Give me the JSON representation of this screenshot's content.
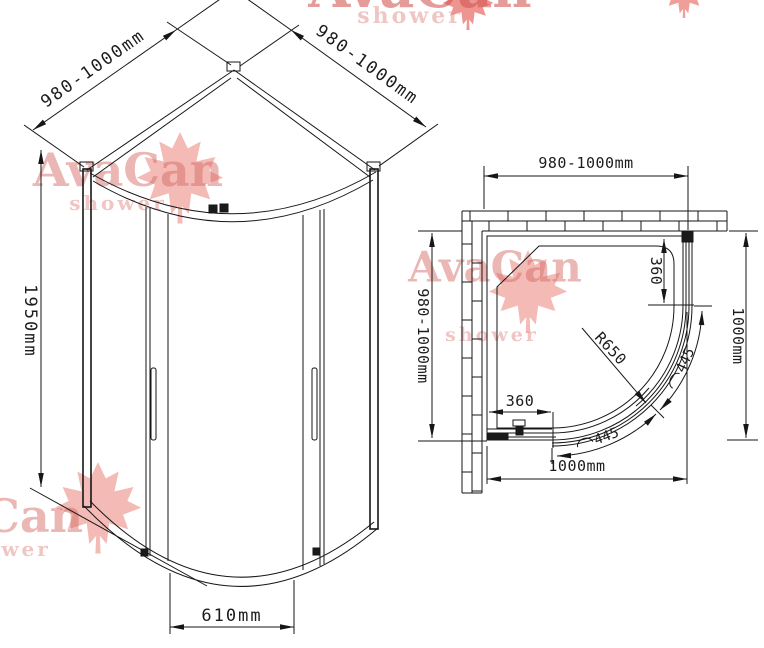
{
  "brand": {
    "name": "AvaCan",
    "tagline": "shower"
  },
  "front_view": {
    "left_width_dim": "980-1000mm",
    "right_width_dim": "980-1000mm",
    "height_dim": "1950mm",
    "door_opening_dim": "610mm"
  },
  "plan_view": {
    "top_width_dim": "980-1000mm",
    "left_depth_dim": "980-1000mm",
    "right_depth_dim": "1000mm",
    "bottom_width_dim": "1000mm",
    "right_fixed_panel_dim": "360",
    "bottom_fixed_panel_dim": "360",
    "glass_radius_dim": "R650",
    "door_arc_symbol": "⌒",
    "door_arc_dim_1": "445",
    "door_arc_dim_2": "445"
  },
  "colors": {
    "line": "#161616",
    "dim_text": "#1c1c1c",
    "watermark_text": "#d56962",
    "watermark_leaf": "#e05a50",
    "background": "#ffffff"
  }
}
